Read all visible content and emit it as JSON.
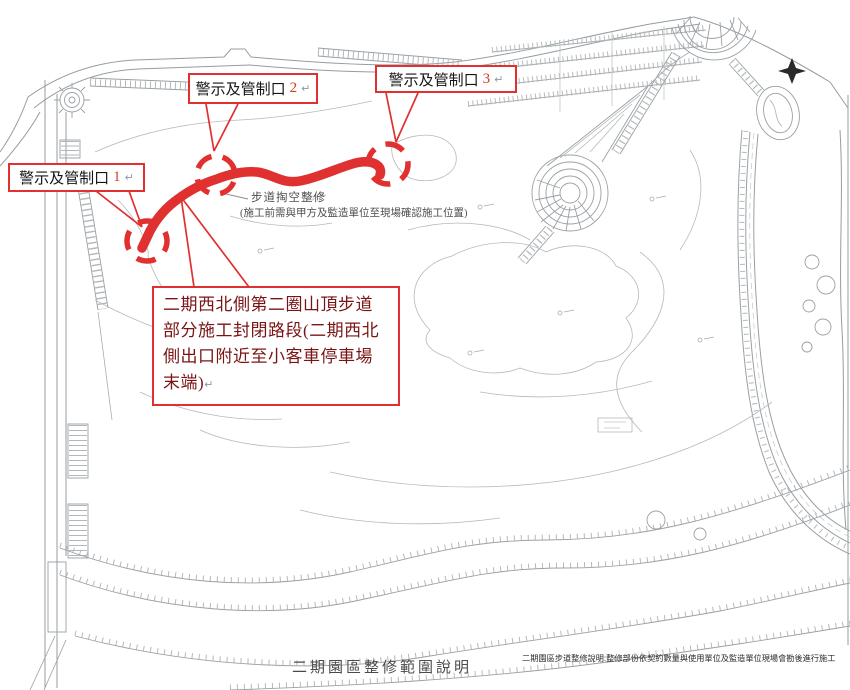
{
  "callouts": [
    {
      "label": "警示及管制口",
      "num": "1",
      "pilcrow": "↵"
    },
    {
      "label": "警示及管制口",
      "num": "2",
      "pilcrow": "↵"
    },
    {
      "label": "警示及管制口",
      "num": "3",
      "pilcrow": "↵"
    }
  ],
  "annotation": {
    "line1": "步道掏空整修",
    "line2": "(施工前需與甲方及監造單位至現場確認施工位置)"
  },
  "closure_note": {
    "text": "二期西北側第二圈山頂步道部分施工封閉路段(二期西北側出口附近至小客車停車場末端)",
    "pilcrow": "↵"
  },
  "footer": {
    "title": "二期園區整修範圍說明",
    "note": "二期園區步道整修說明:整修部份依契約數量與使用單位及監造單位現場會勘後進行施工"
  },
  "icons": {
    "north_arrow": "north-arrow"
  },
  "colors": {
    "annotation_red": "#e03030",
    "closure_text_red": "#7a1414",
    "map_line_gray": "#969ca1",
    "map_light_gray": "#b4b9bc"
  }
}
